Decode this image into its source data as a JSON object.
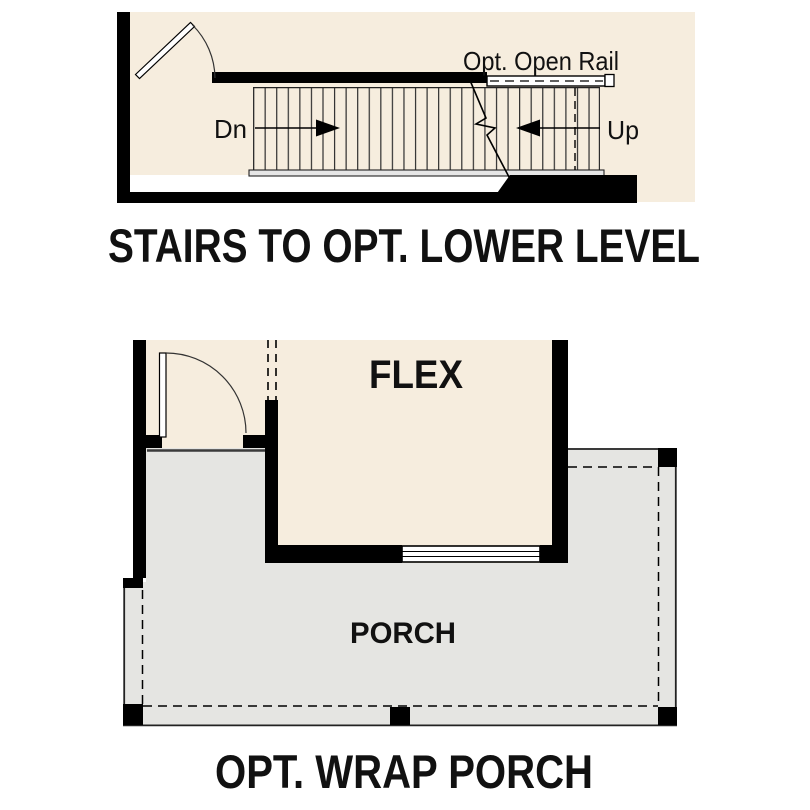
{
  "stairs_diagram": {
    "title": "STAIRS TO OPT. LOWER LEVEL",
    "labels": {
      "down": "Dn",
      "up": "Up",
      "open_rail": "Opt. Open Rail"
    }
  },
  "porch_diagram": {
    "title": "OPT. WRAP PORCH",
    "labels": {
      "flex_room": "FLEX",
      "porch": "PORCH"
    }
  },
  "colors": {
    "interior_fill": "#f6edde",
    "porch_fill": "#e5e5e2",
    "wall": "#000000",
    "background": "#ffffff"
  }
}
